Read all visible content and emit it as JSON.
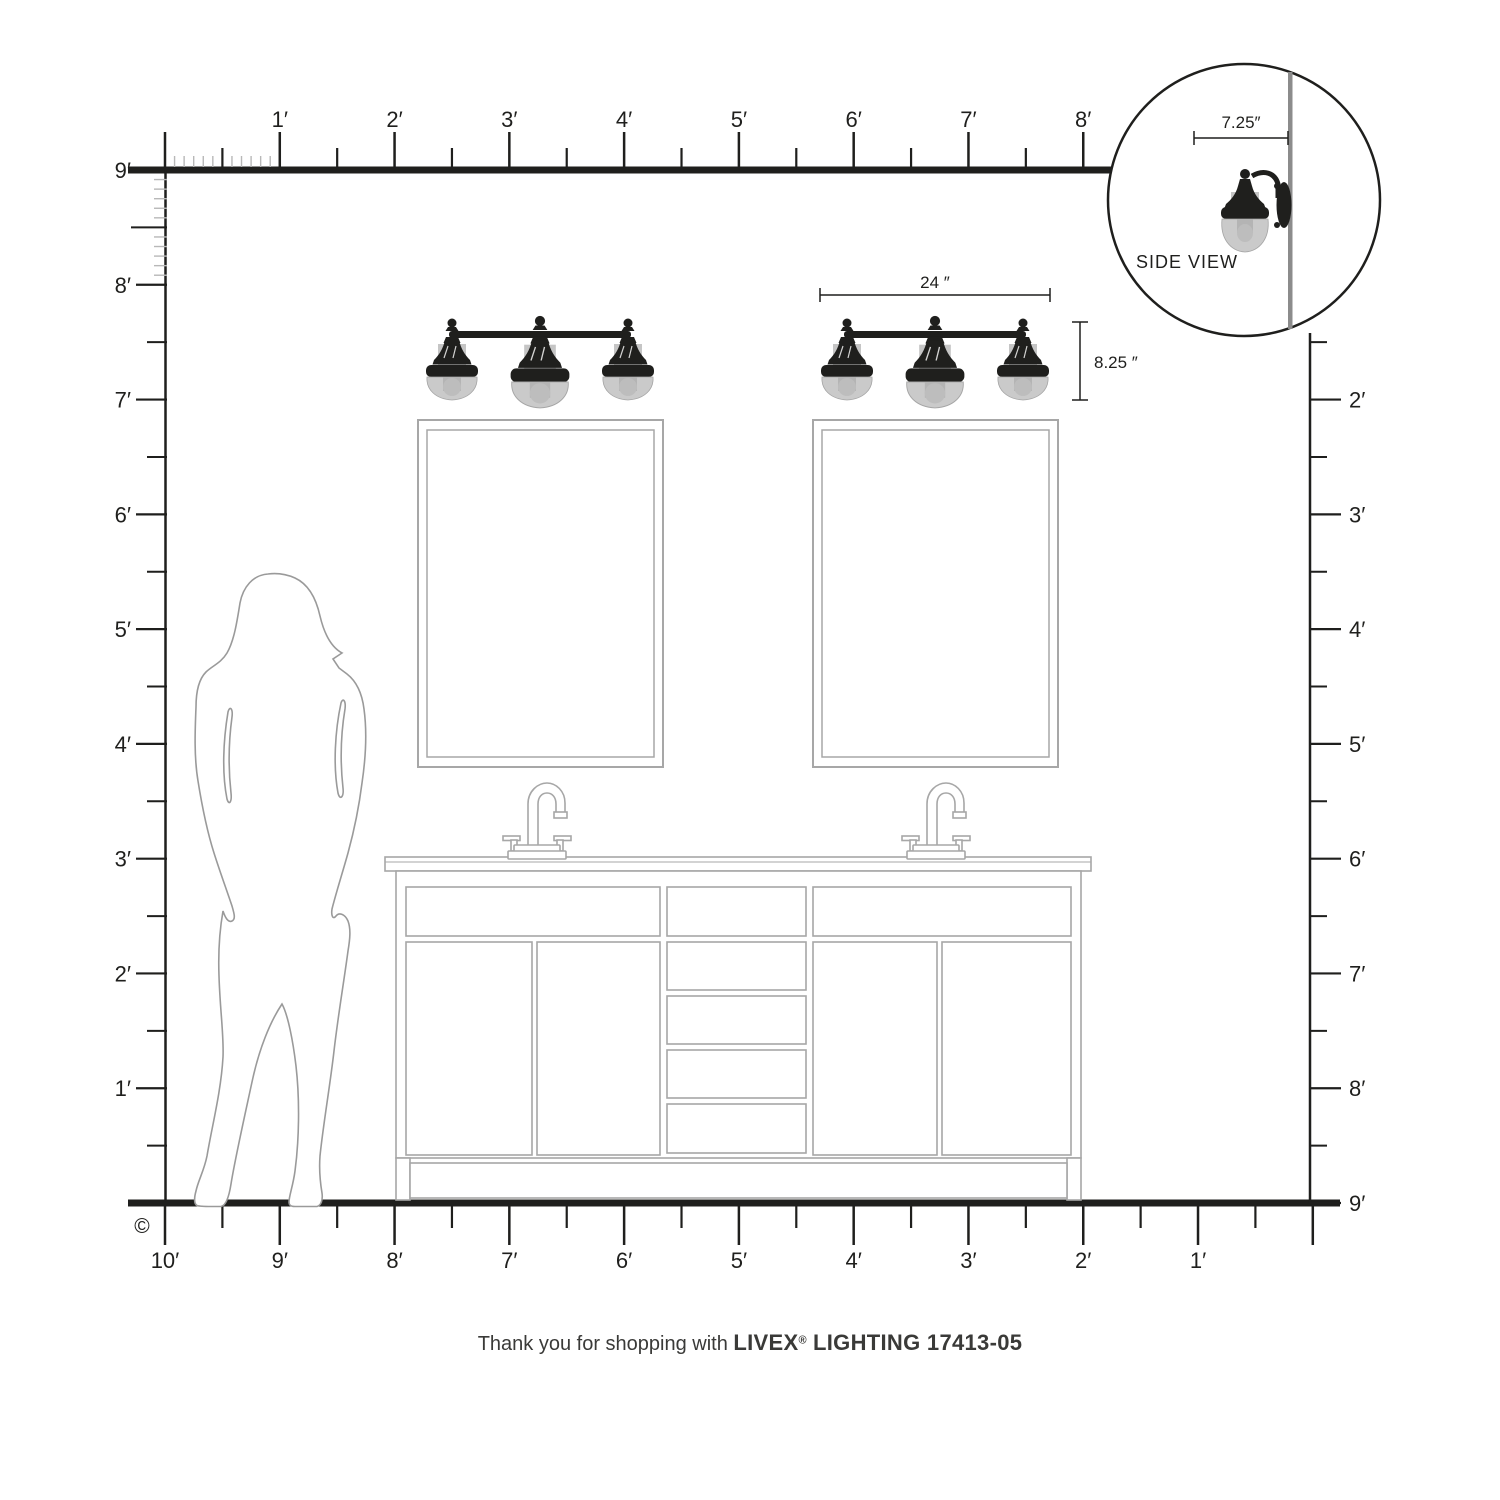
{
  "caption": {
    "prefix": "Thank you for shopping with ",
    "brand": "LIVEX",
    "registered": "®",
    "product": " LIGHTING 17413-05"
  },
  "copyright_symbol": "©",
  "annotations": {
    "fixture_width": "24 ″",
    "fixture_height": "8.25 ″",
    "side_view_depth": "7.25″",
    "side_view_label": "SIDE VIEW"
  },
  "rulers": {
    "top_labels": [
      "1′",
      "2′",
      "3′",
      "4′",
      "5′",
      "6′",
      "7′",
      "8′"
    ],
    "left_labels": [
      "9′",
      "8′",
      "7′",
      "6′",
      "5′",
      "4′",
      "3′",
      "2′",
      "1′"
    ],
    "right_labels": [
      "2′",
      "3′",
      "4′",
      "5′",
      "6′",
      "7′",
      "8′",
      "9′"
    ],
    "bottom_labels": [
      "10′",
      "9′",
      "8′",
      "7′",
      "6′",
      "5′",
      "4′",
      "3′",
      "2′",
      "1′"
    ]
  },
  "colors": {
    "ink": "#1f1f1d",
    "furniture_gray": "#a7a7a7",
    "silhouette_gray": "#9a9a9a",
    "glass_gray": "#cacaca",
    "glass_band_gray": "#c5c5c5",
    "glass_inner_gray": "#b4b4b4",
    "wall_gray": "#8c8c8c",
    "inch_tick_gray": "#b8b8b8"
  }
}
